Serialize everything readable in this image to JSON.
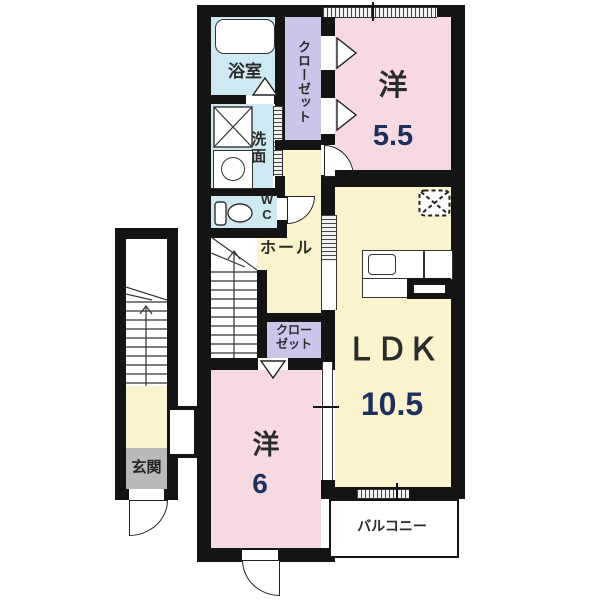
{
  "plan": {
    "rooms": {
      "bathroom": {
        "label": "浴室"
      },
      "washroom": {
        "label": "洗面"
      },
      "wc": {
        "line1": "W",
        "line2": "C"
      },
      "closet_upper": {
        "label": "クローゼット"
      },
      "hall": {
        "label": "ホール"
      },
      "closet_lower": {
        "line1": "クロー",
        "line2": "ゼット"
      },
      "western_55": {
        "label": "洋",
        "size": "5.5"
      },
      "ldk": {
        "label": "ＬＤＫ",
        "size": "10.5"
      },
      "western_6": {
        "label": "洋",
        "size": "6"
      },
      "entrance": {
        "label": "玄関"
      },
      "balcony": {
        "label": "バルコニー"
      }
    },
    "colors": {
      "wall": "#141414",
      "room_pink": "#f7d9e4",
      "room_yellow": "#faf3cd",
      "room_blue": "#cfe9f3",
      "closet_purple": "#c9c6ea",
      "entrance_gray": "#b9b9b9",
      "number_navy": "#1c2f5f"
    }
  }
}
